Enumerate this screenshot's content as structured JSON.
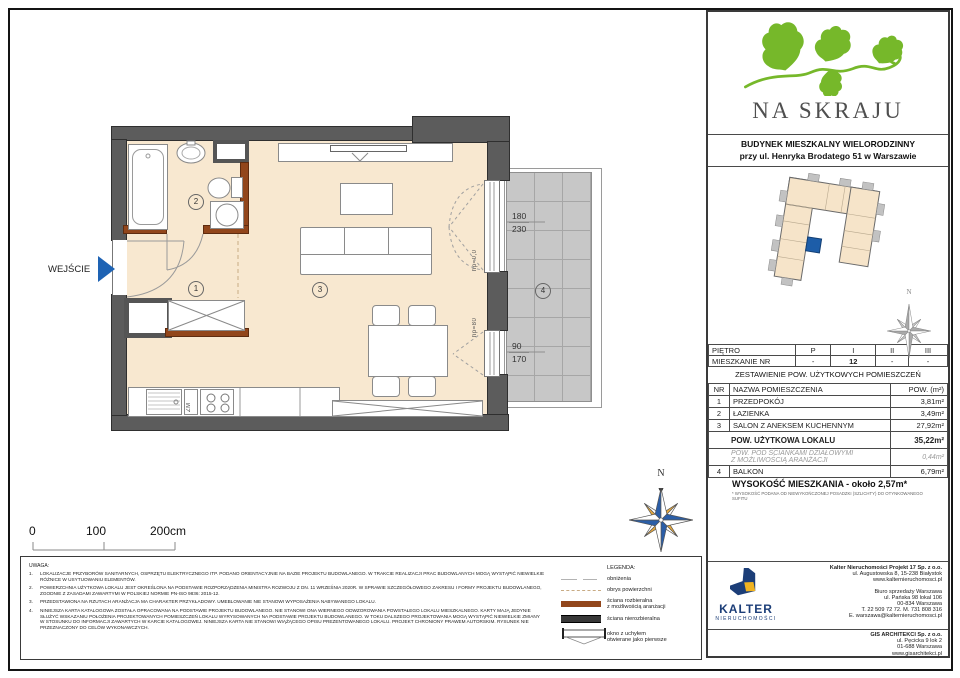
{
  "logo": {
    "title": "NA SKRAJU",
    "subtitle1": "BUDYNEK MIESZKALNY WIELORODZINNY",
    "subtitle2": "przy ul. Henryka Brodatego 51 w Warszawie"
  },
  "plan": {
    "entrance": "WEJŚCIE",
    "rooms": [
      "1",
      "2",
      "3",
      "4"
    ],
    "zm": "ZM",
    "hp_door": "hp=0,0",
    "hp_window": "hp=80",
    "dim_top_w": "180",
    "dim_top_h": "230",
    "dim_bot_w": "90",
    "dim_bot_h": "170",
    "scale": {
      "s0": "0",
      "s1": "100",
      "s2": "200cm"
    },
    "compass_n": "N"
  },
  "tables": {
    "floor": {
      "rows": [
        [
          "PIĘTRO",
          "P",
          "I",
          "II",
          "III"
        ],
        [
          "MIESZKANIE NR",
          "-",
          "12",
          "-",
          "-"
        ]
      ]
    },
    "summary_title": "ZESTAWIENIE POW. UŻYTKOWYCH POMIESZCZEŃ",
    "area": {
      "headers": [
        "NR",
        "NAZWA POMIESZCZENIA",
        "POW. (m²)"
      ],
      "rows": [
        [
          "1",
          "PRZEDPOKÓJ",
          "3,81m²"
        ],
        [
          "2",
          "ŁAZIENKA",
          "3,49m²"
        ],
        [
          "3",
          "SALON Z ANEKSEM KUCHENNYM",
          "27,92m²"
        ]
      ],
      "total_label": "POW. UŻYTKOWA LOKALU",
      "total_value": "35,22m²",
      "partition_l1": "POW. POD ŚCIANKAMI DZIAŁOWYMI",
      "partition_l2": "Z MOŻLIWOŚCIĄ ARANŻACJI",
      "partition_value": "0,44m²",
      "balcony": [
        "4",
        "BALKON",
        "6,79m²"
      ]
    },
    "height_note": "WYSOKOŚĆ MIESZKANIA - około 2,57m*",
    "height_footnote": "* WYSOKOŚĆ PODANA OD NIEWYKOŃCZONEJ POSADZKI (SZLICHTY) DO OTYNKOWANEGO SUFITU"
  },
  "notes": {
    "title": "UWAGA:",
    "items": [
      {
        "n": "1.",
        "text": "LOKALIZACJE PRZYBORÓW SANITARNYCH, OSPRZĘTU ELEKTRYCZNEGO ITP. PODANO ORIENTACYJNIE NA BAZIE PROJEKTU BUDOWLANEGO. W TRAKCIE REALIZACJI PRAC BUDOWLANYCH MOGĄ WYSTĄPIĆ NIEWIELKIE RÓŻNICE W USYTUOWANIU ELEMENTÓW."
      },
      {
        "n": "2.",
        "text": "POWIERZCHNIA UŻYTKOWA LOKALU JEST OKREŚLONA NA PODSTAWIE ROZPORZĄDZENIA MINISTRA ROZWOJU Z DN. 11 WRZEŚNIA 2020R. W SPRAWIE SZCZEGÓŁOWEGO ZAKRESU I FORMY PROJEKTU BUDOWLANEGO, ZGODNIE Z ZASADAMI ZAWARTYMI W POLSKIEJ NORMIE PN-ISO 9836: 2015-12."
      },
      {
        "n": "3.",
        "text": "PRZEDSTAWIONA NA RZUTACH ARANŻACJA MA CHARAKTER PRZYKŁADOWY. UMEBLOWANIE NIE STANOWI WYPOSAŻENIA NABYWANEGO LOKALU."
      },
      {
        "n": "4.",
        "text": "NINIEJSZA KARTA KATALOGOWA ZOSTAŁA OPRACOWANA NA PODSTAWIE PROJEKTU BUDOWLANEGO. NIE STANOWI ONA WIERNEGO ODWZOROWANIA POWSTAŁEGO LOKALU MIESZKALNEGO. KARTY MAJĄ JEDYNIE SŁUŻYĆ WSKAZANIU POŁOŻENIA PROJEKTOWANYCH POMIESZCZEŃ LOKALU WYRYSOWANYCH NA PODSTAWIE PROJEKTU BUDOWLANEGO. W TOKU DALSZEGO PROJEKTOWANIA MOGĄ WYSTĄPIĆ NIEWIELKIE ZMIANY W STOSUNKU DO INFORMACJI ZAWARTYCH W KARCIE KATALOGOWEJ. NINIEJSZA KARTA NIE STANOWI WIĄŻĄCEGO OPISU PREZENTOWANEGO LOKALU. PROJEKT CHRONIONY PRAWEM AUTORSKIM. RYSUNEK NIE PRZEZNACZONY DO CELÓW WYKONAWCZYCH."
      }
    ]
  },
  "legend": {
    "title": "LEGENDA:",
    "items": [
      {
        "l1": "obniżenia",
        "l2": ""
      },
      {
        "l1": "obrys powierzchni",
        "l2": ""
      },
      {
        "l1": "ściana rozbieralna",
        "l2": "z możliwością aranżacji"
      },
      {
        "l1": "ściana nierozbieralna",
        "l2": ""
      },
      {
        "l1": "okno z uchyłem",
        "l2": "otwierane jako pierwsze"
      }
    ]
  },
  "footer": {
    "kalter_name": "KALTER",
    "kalter_sub": "nieruchomości",
    "lines1": [
      "Kalter Nieruchomości Projekt 17 Sp. z o.o.",
      "ul. Augustowska 8, 15-238 Białystok",
      "www.kalternieruchomosci.pl"
    ],
    "lines2": [
      "Biuro sprzedaży Warszawa",
      "ul. Pańska 98 lokal 106",
      "00-834 Warszawa",
      "T. 22 509 72 72. M. 731 808 316",
      "E. warszawa@kalternieruchomosci.pl"
    ],
    "gis": [
      "GIS ARCHITEKCI Sp. z o.o.",
      "ul. Pęcicka 9 lok 2",
      "01-688 Warszawa",
      "www.gisarchitekci.pl"
    ]
  },
  "colors": {
    "floor_beige": "#f8e8d0",
    "wall_gray": "#5c5c5c",
    "partition_brown": "#92461b",
    "balcony_gray": "#c7c7c7",
    "accent_blue": "#1e63b4",
    "brand_green": "#76b82a",
    "kalter_navy": "#1c3e78",
    "kalter_yellow": "#f0b321"
  }
}
